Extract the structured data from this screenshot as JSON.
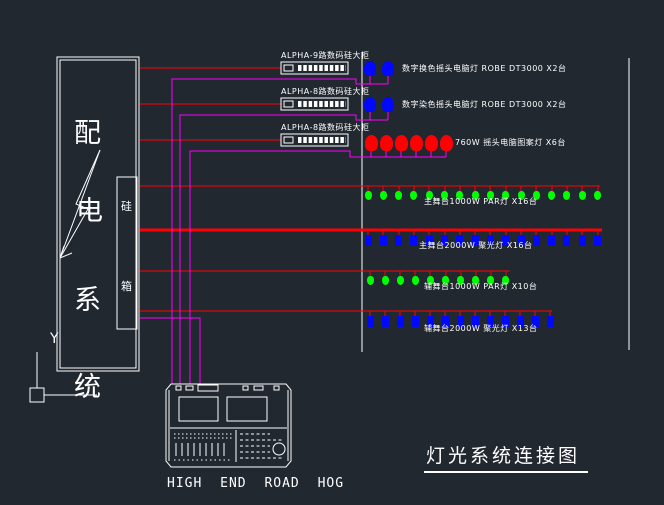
{
  "drawing_title": "灯光系统连接图",
  "ucs_axis_label": "Y",
  "console": {
    "label": "HIGH END ROAD HOG"
  },
  "distribution_box": {
    "chars": [
      "配",
      "电",
      "系",
      "统"
    ],
    "dimmer_box_chars": [
      "硅",
      "箱"
    ],
    "symbol": "lightning-bolt-icon"
  },
  "dimmer_racks": [
    {
      "label": "ALPHA-9路数码硅大柜"
    },
    {
      "label": "ALPHA-8路数码硅大柜"
    },
    {
      "label": "ALPHA-8路数码硅大柜"
    }
  ],
  "fixture_rows": [
    {
      "label": "数字换色摇头电脑灯 ROBE DT3000 X2台",
      "count": 2,
      "fixture": "moving-head",
      "color": "#0008ff"
    },
    {
      "label": "数字染色摇头电脑灯 ROBE DT3000 X2台",
      "count": 2,
      "fixture": "moving-head",
      "color": "#0008ff"
    },
    {
      "label": "760W 摇头电脑图案灯  X6台",
      "count": 6,
      "fixture": "moving-head",
      "color": "#ff0000"
    },
    {
      "label": "主舞台1000W PAR灯  X16台",
      "count": 16,
      "fixture": "par",
      "color": "#00ff00"
    },
    {
      "label": "主舞台2000W 聚光灯  X16台",
      "count": 16,
      "fixture": "spot",
      "color": "#0008ff"
    },
    {
      "label": "辅舞台1000W PAR灯  X10台",
      "count": 10,
      "fixture": "par",
      "color": "#00ff00"
    },
    {
      "label": "辅舞台2000W 聚光灯  X13台",
      "count": 13,
      "fixture": "spot",
      "color": "#0008ff"
    }
  ],
  "colors": {
    "background": "#212830",
    "line_white": "#ffffff",
    "power_wire_red": "#ff0000",
    "dmx_wire_magenta": "#ff00ff",
    "fixture_blue": "#0008ff",
    "fixture_green": "#00ff00",
    "fixture_red": "#ff0000"
  }
}
